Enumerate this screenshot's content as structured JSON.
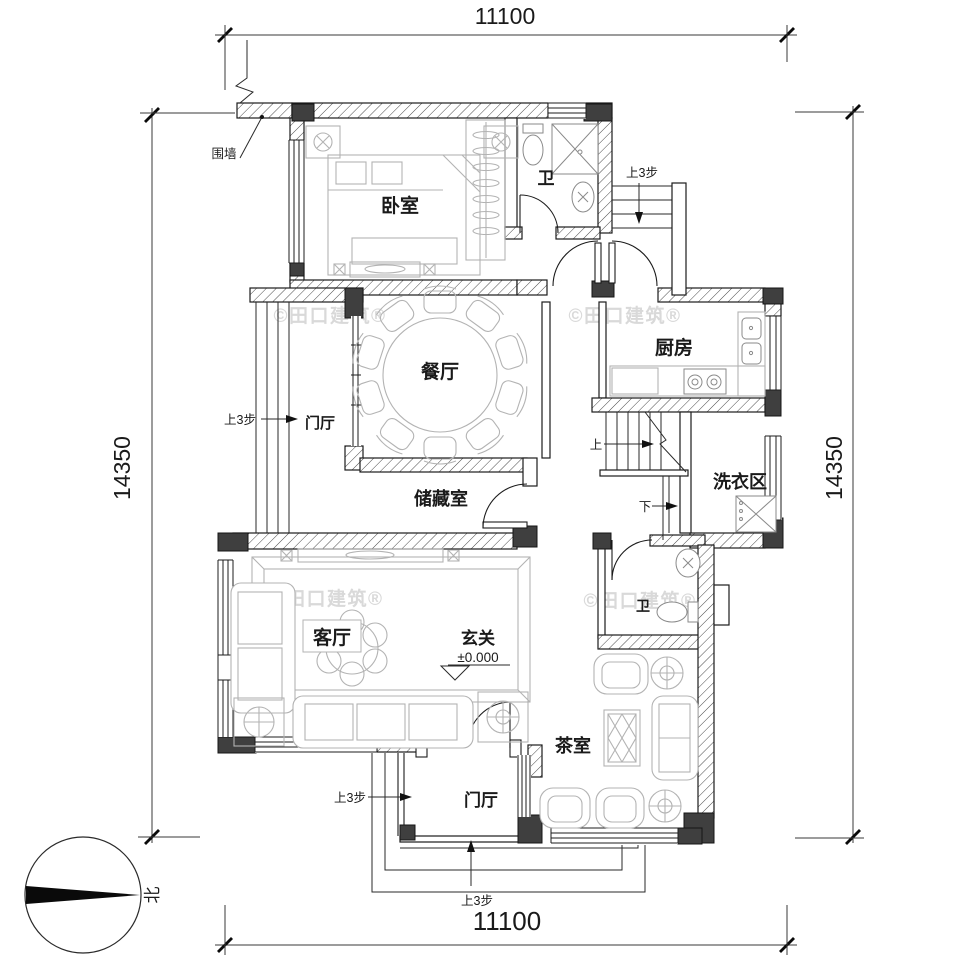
{
  "dimensions": {
    "top": "11100",
    "bottom": "11100",
    "left": "14350",
    "right": "14350"
  },
  "rooms": {
    "bedroom": "卧室",
    "bath_top": "卫",
    "kitchen": "厨房",
    "dining": "餐厅",
    "foyer_left": "门厅",
    "storage": "储藏室",
    "laundry": "洗衣区",
    "bath_lower": "卫",
    "living": "客厅",
    "entry": "玄关",
    "tea_room": "茶室",
    "foyer_bottom": "门厅"
  },
  "annotations": {
    "fence": "围墙",
    "steps_top_right": "上3步",
    "steps_left": "上3步",
    "steps_bottom_left": "上3步",
    "steps_bottom_center": "上3步",
    "stairs_up": "上",
    "stairs_down": "下",
    "elevation": "±0.000",
    "north": "北"
  },
  "watermark": {
    "text": "©田口建筑®"
  },
  "colors": {
    "wall_line": "#1c1c1c",
    "column_fill": "#3f3f3f",
    "furniture_line": "#b3b3b3",
    "watermark": "#d9d9d9",
    "background": "#ffffff"
  }
}
